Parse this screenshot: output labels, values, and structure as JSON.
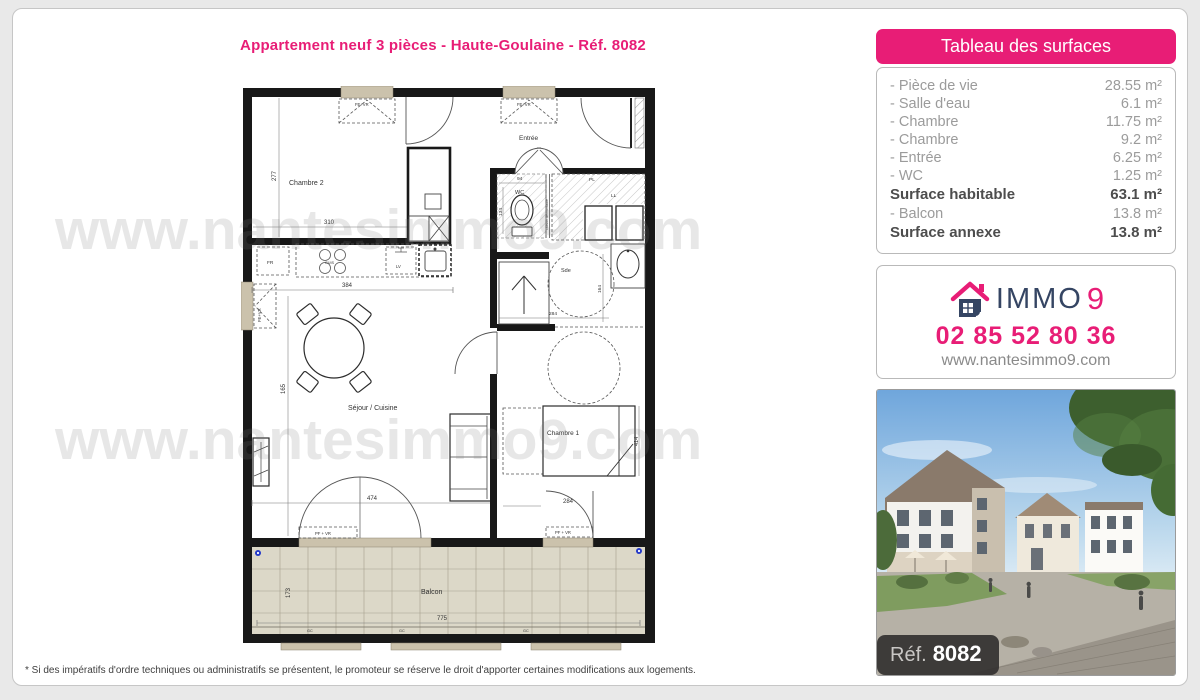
{
  "page": {
    "title": "Appartement neuf 3 pièces - Haute-Goulaine - Réf. 8082",
    "watermark": "www.nantesimmo9.com",
    "footnote": "* Si des impératifs d'ordre techniques ou administratifs se présentent, le promoteur se réserve le droit d'apporter certaines modifications aux logements."
  },
  "surfaces": {
    "header": "Tableau des surfaces",
    "rows": [
      {
        "label": "- Pièce de vie",
        "value": "28.55 m²"
      },
      {
        "label": "- Salle d'eau",
        "value": "6.1 m²"
      },
      {
        "label": "- Chambre",
        "value": "11.75 m²"
      },
      {
        "label": "- Chambre",
        "value": "9.2 m²"
      },
      {
        "label": "- Entrée",
        "value": "6.25 m²"
      },
      {
        "label": "- WC",
        "value": "1.25 m²"
      },
      {
        "label": "Surface habitable",
        "value": "63.1 m²"
      },
      {
        "label": "- Balcon",
        "value": "13.8 m²"
      },
      {
        "label": "Surface annexe",
        "value": "13.8 m²"
      }
    ]
  },
  "agency": {
    "brand_word": "IMMO",
    "brand_nine": "9",
    "phone": "02 85 52 80 36",
    "website": "www.nantesimmo9.com"
  },
  "photo": {
    "ref_label": "Réf.",
    "ref_number": "8082"
  },
  "plan": {
    "rooms": {
      "chambre2": "Chambre 2",
      "entree": "Entrée",
      "wc": "WC",
      "sde": "Sde",
      "chambre1": "Chambre 1",
      "sejour": "Séjour / Cuisine",
      "balcon": "Balcon"
    },
    "fixtures": {
      "fr": "FR",
      "cuis": "CUIS",
      "lv": "LV",
      "pl": "PL",
      "ll": "LL",
      "cloison": "cloison démontable"
    },
    "windows": {
      "fe_vr": "FE+VR",
      "pf_vr": "PF + VR"
    },
    "dims": {
      "d277": "277",
      "d310": "310",
      "d384": "384",
      "d94": "94",
      "d134": "134",
      "d164": "164",
      "d284_sde": "284",
      "d165": "165",
      "d474": "474",
      "d284_ch1": "284",
      "d414": "414",
      "d775": "775",
      "d173": "173",
      "gc": "GC"
    }
  },
  "colors": {
    "pink": "#e81d76",
    "navy": "#354563",
    "wall": "#181818",
    "tan": "#cbc2ac",
    "tile": "#dcd8c8"
  }
}
